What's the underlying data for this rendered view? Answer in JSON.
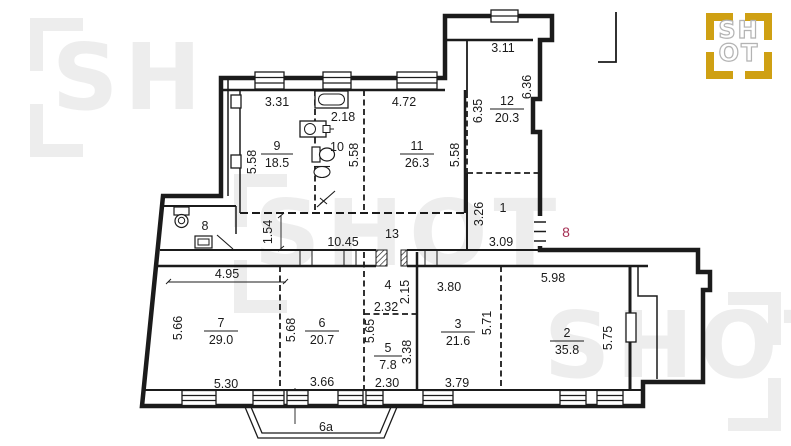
{
  "colors": {
    "wall": "#1b1b1b",
    "apartment_number_red": "#a63054",
    "watermark_gray": "#ededed",
    "logo_gold": "#cfa013"
  },
  "watermark": {
    "text": "SHOT"
  },
  "logo": {
    "line1": "SH",
    "line2": "OT"
  },
  "apartment": {
    "number": "8"
  },
  "balcony": {
    "label": "6a"
  },
  "rooms": [
    {
      "number": "9",
      "area": "18.5"
    },
    {
      "number": "10",
      "area": null
    },
    {
      "number": "11",
      "area": "26.3"
    },
    {
      "number": "12",
      "area": "20.3"
    },
    {
      "number": "1",
      "area": null
    },
    {
      "number": "13",
      "area": null
    },
    {
      "number": "8",
      "area": null
    },
    {
      "number": "7",
      "area": "29.0"
    },
    {
      "number": "6",
      "area": "20.7"
    },
    {
      "number": "4",
      "area": null
    },
    {
      "number": "5",
      "area": "7.8"
    },
    {
      "number": "3",
      "area": "21.6"
    },
    {
      "number": "2",
      "area": "35.8"
    }
  ],
  "dims_h": [
    {
      "t": "3.31"
    },
    {
      "t": "2.18"
    },
    {
      "t": "4.72"
    },
    {
      "t": "3.11"
    },
    {
      "t": "10.45"
    },
    {
      "t": "3.09"
    },
    {
      "t": "4.95"
    },
    {
      "t": "2.32"
    },
    {
      "t": "3.80"
    },
    {
      "t": "5.98"
    },
    {
      "t": "5.30"
    },
    {
      "t": "3.66"
    },
    {
      "t": "2.30"
    },
    {
      "t": "3.79"
    }
  ],
  "dims_v": [
    {
      "t": "5.58"
    },
    {
      "t": "5.58"
    },
    {
      "t": "5.58"
    },
    {
      "t": "6.35"
    },
    {
      "t": "6.36"
    },
    {
      "t": "3.26"
    },
    {
      "t": "1.54"
    },
    {
      "t": "5.66"
    },
    {
      "t": "5.68"
    },
    {
      "t": "5.65"
    },
    {
      "t": "2.15"
    },
    {
      "t": "3.38"
    },
    {
      "t": "5.71"
    },
    {
      "t": "5.75"
    }
  ]
}
